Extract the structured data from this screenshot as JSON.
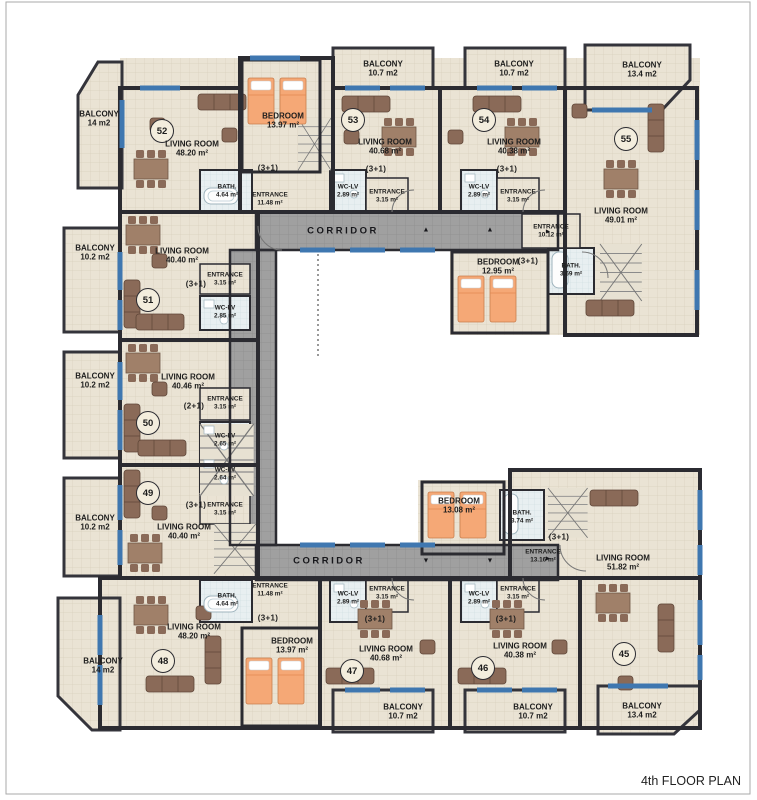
{
  "title": "4th FLOOR PLAN",
  "corridor": {
    "label": "CORRIDOR"
  },
  "icons": {
    "arrow_up": "▲",
    "arrow_down": "▼",
    "arrow_right": "►"
  },
  "colors": {
    "floor": "#eae3d4",
    "wall": "#2b2b31",
    "corridor_floor": "#a0a0a0",
    "window": "#3f77b0",
    "furniture": "#8a6a58",
    "bed": "#f5a876",
    "wet_room": "#e8eff1"
  },
  "units": [
    {
      "number": "45",
      "type": "(3+1)",
      "living_name": "LIVING ROOM",
      "living_area": "51.82 m²",
      "bedroom_name": "BEDROOM",
      "bedroom_area": "13.08 m²",
      "bath_name": "BATH.",
      "bath_area": "3.74 m²",
      "entrance_name": "ENTRANCE",
      "entrance_area": "13.16 m²",
      "balcony_name": "BALCONY",
      "balcony_area": "13.4 m2"
    },
    {
      "number": "46",
      "type": "(3+1)",
      "living_name": "LIVING ROOM",
      "living_area": "40.38 m²",
      "wc_name": "WC-LV",
      "wc_area": "2.89 m²",
      "entrance_name": "ENTRANCE",
      "entrance_area": "3.15 m²",
      "balcony_name": "BALCONY",
      "balcony_area": "10.7 m2"
    },
    {
      "number": "47",
      "type": "(3+1)",
      "living_name": "LIVING ROOM",
      "living_area": "40.68 m²",
      "wc_name": "WC-LV",
      "wc_area": "2.89 m²",
      "entrance_name": "ENTRANCE",
      "entrance_area": "3.15 m²",
      "balcony_name": "BALCONY",
      "balcony_area": "10.7 m2"
    },
    {
      "number": "48",
      "type": "(3+1)",
      "living_name": "LIVING ROOM",
      "living_area": "48.20 m²",
      "bedroom_name": "BEDROOM",
      "bedroom_area": "13.97 m²",
      "bath_name": "BATH.",
      "bath_area": "4.64 m²",
      "entrance_name": "ENTRANCE",
      "entrance_area": "11.48 m²",
      "balcony_name": "BALCONY",
      "balcony_area": "14 m2"
    },
    {
      "number": "49",
      "type": "(3+1)",
      "living_name": "LIVING ROOM",
      "living_area": "40.40 m²",
      "wc_name": "WC-LV",
      "wc_area": "2.64 m²",
      "entrance_name": "ENTRANCE",
      "entrance_area": "3.15 m²",
      "balcony_name": "BALCONY",
      "balcony_area": "10.2 m2"
    },
    {
      "number": "50",
      "type": "(2+1)",
      "living_name": "LIVING ROOM",
      "living_area": "40.46 m²",
      "wc_name": "WC-LV",
      "wc_area": "2.65 m²",
      "entrance_name": "ENTRANCE",
      "entrance_area": "3.15 m²",
      "balcony_name": "BALCONY",
      "balcony_area": "10.2 m2"
    },
    {
      "number": "51",
      "type": "(3+1)",
      "living_name": "LIVING ROOM",
      "living_area": "40.40 m²",
      "wc_name": "WC-LV",
      "wc_area": "2.85 m²",
      "entrance_name": "ENTRANCE",
      "entrance_area": "3.15 m²",
      "balcony_name": "BALCONY",
      "balcony_area": "10.2 m2"
    },
    {
      "number": "52",
      "type": "(3+1)",
      "living_name": "LIVING ROOM",
      "living_area": "48.20 m²",
      "bedroom_name": "BEDROOM",
      "bedroom_area": "13.97 m²",
      "bath_name": "BATH.",
      "bath_area": "4.64 m²",
      "entrance_name": "ENTRANCE",
      "entrance_area": "11.48 m²",
      "balcony_name": "BALCONY",
      "balcony_area": "14 m2"
    },
    {
      "number": "53",
      "type": "(3+1)",
      "living_name": "LIVING ROOM",
      "living_area": "40.68 m²",
      "wc_name": "WC-LV",
      "wc_area": "2.89 m²",
      "entrance_name": "ENTRANCE",
      "entrance_area": "3.15 m²",
      "balcony_name": "BALCONY",
      "balcony_area": "10.7 m2"
    },
    {
      "number": "54",
      "type": "(3+1)",
      "living_name": "LIVING ROOM",
      "living_area": "40.38 m²",
      "wc_name": "WC-LV",
      "wc_area": "2.89 m²",
      "entrance_name": "ENTRANCE",
      "entrance_area": "3.15 m²",
      "balcony_name": "BALCONY",
      "balcony_area": "10.7 m2"
    },
    {
      "number": "55",
      "type": "(3+1)",
      "living_name": "LIVING ROOM",
      "living_area": "49.01 m²",
      "bedroom_name": "BEDROOM",
      "bedroom_area": "12.95 m²",
      "bath_name": "BATH.",
      "bath_area": "3.69 m²",
      "entrance_name": "ENTRANCE",
      "entrance_area": "10.12 m²",
      "balcony_name": "BALCONY",
      "balcony_area": "13.4 m2"
    }
  ]
}
